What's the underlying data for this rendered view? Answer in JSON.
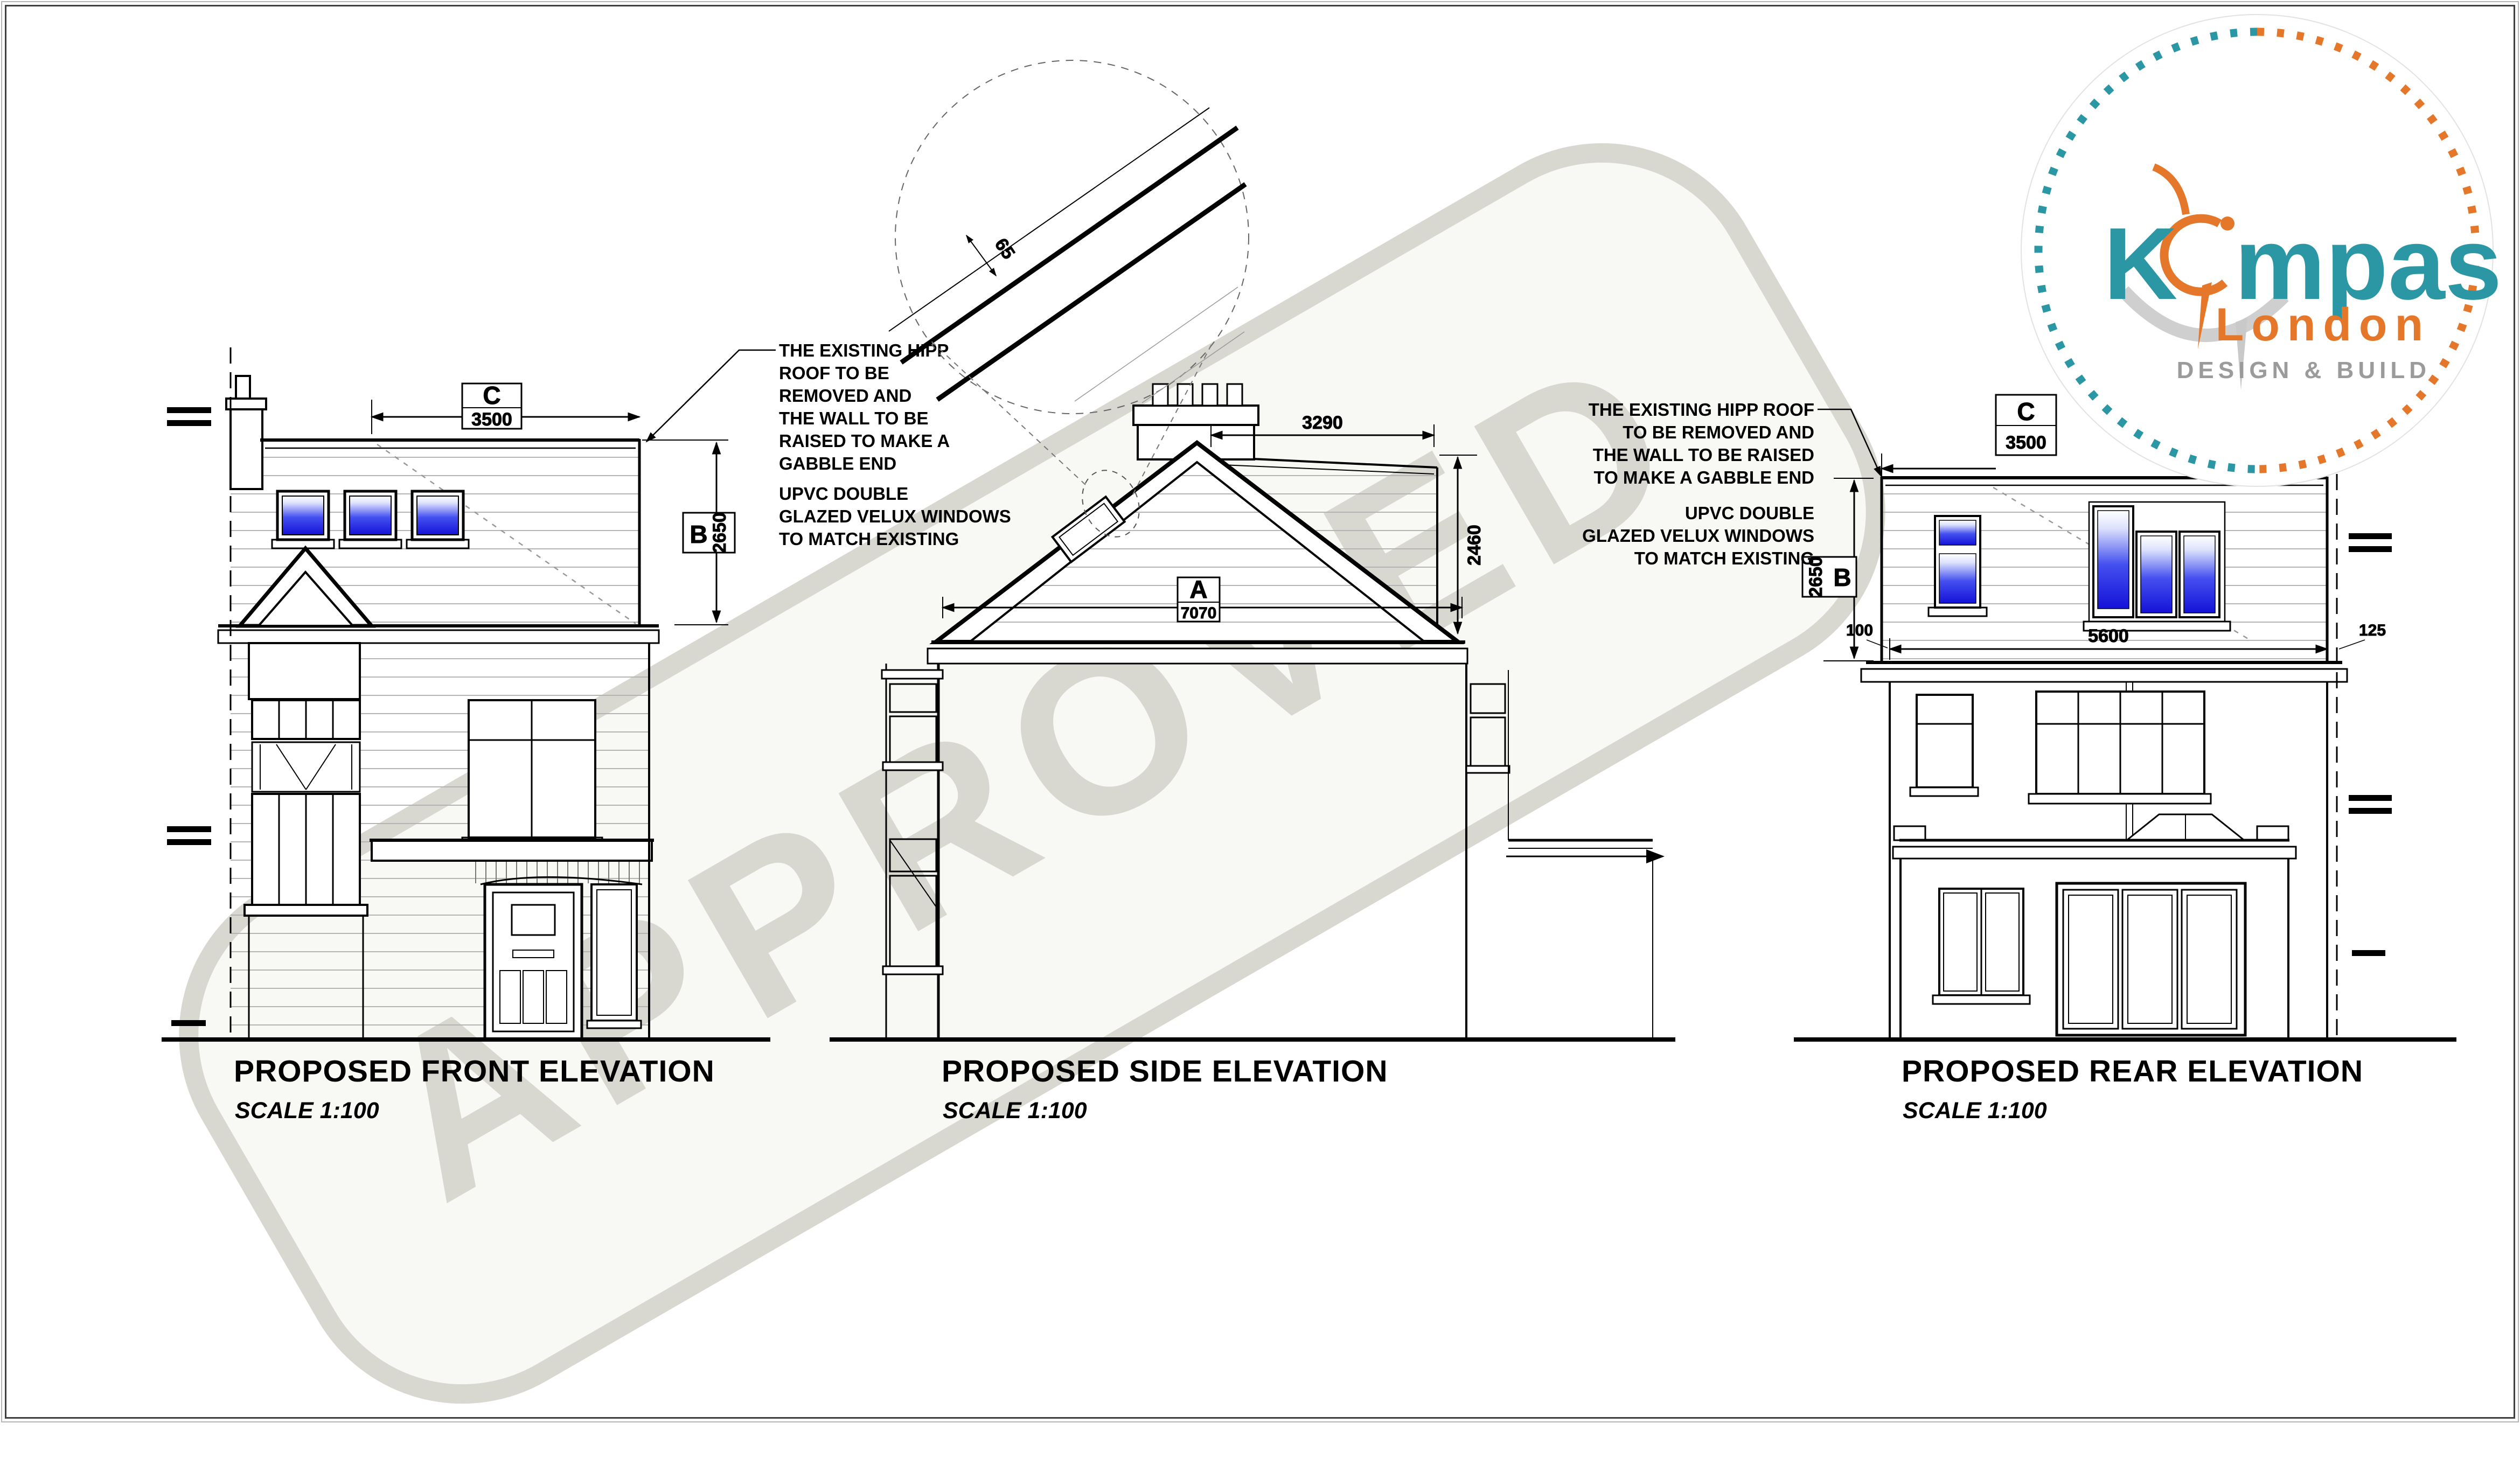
{
  "watermark": {
    "text": "APPROVED"
  },
  "logo": {
    "brand_k": "K",
    "brand_rest": "mpas",
    "city": "London",
    "tagline": "DESIGN & BUILD",
    "teal": "#2b97a4",
    "orange": "#e4772a",
    "gray": "#9b9b9b"
  },
  "front": {
    "title": "PROPOSED FRONT ELEVATION",
    "scale": "SCALE 1:100",
    "note_roof": [
      "THE EXISTING HIPP",
      "ROOF TO BE",
      "REMOVED AND",
      "THE WALL TO BE",
      "RAISED TO MAKE A",
      "GABBLE END"
    ],
    "note_velux": [
      "UPVC DOUBLE",
      "GLAZED VELUX WINDOWS",
      "TO MATCH EXISTING"
    ],
    "dim_width_label": "C",
    "dim_width": "3500",
    "dim_height_label": "B",
    "dim_height": "2650"
  },
  "side": {
    "title": "PROPOSED SIDE ELEVATION",
    "scale": "SCALE 1:100",
    "dim_ridge": "3290",
    "dim_roof_height": "2460",
    "dim_width_label": "A",
    "dim_width": "7070",
    "dim_tile": "65"
  },
  "rear": {
    "title": "PROPOSED REAR ELEVATION",
    "scale": "SCALE 1:100",
    "note_roof": [
      "THE EXISTING HIPP ROOF",
      "TO BE REMOVED AND",
      "THE WALL TO BE RAISED",
      "TO MAKE A GABBLE END"
    ],
    "note_velux": [
      "UPVC DOUBLE",
      "GLAZED VELUX WINDOWS",
      "TO MATCH EXISTING"
    ],
    "dim_width_label": "C",
    "dim_width": "3500",
    "dim_height_label": "B",
    "dim_height": "2650",
    "dim_left": "100",
    "dim_wall": "5600",
    "dim_right": "125"
  }
}
